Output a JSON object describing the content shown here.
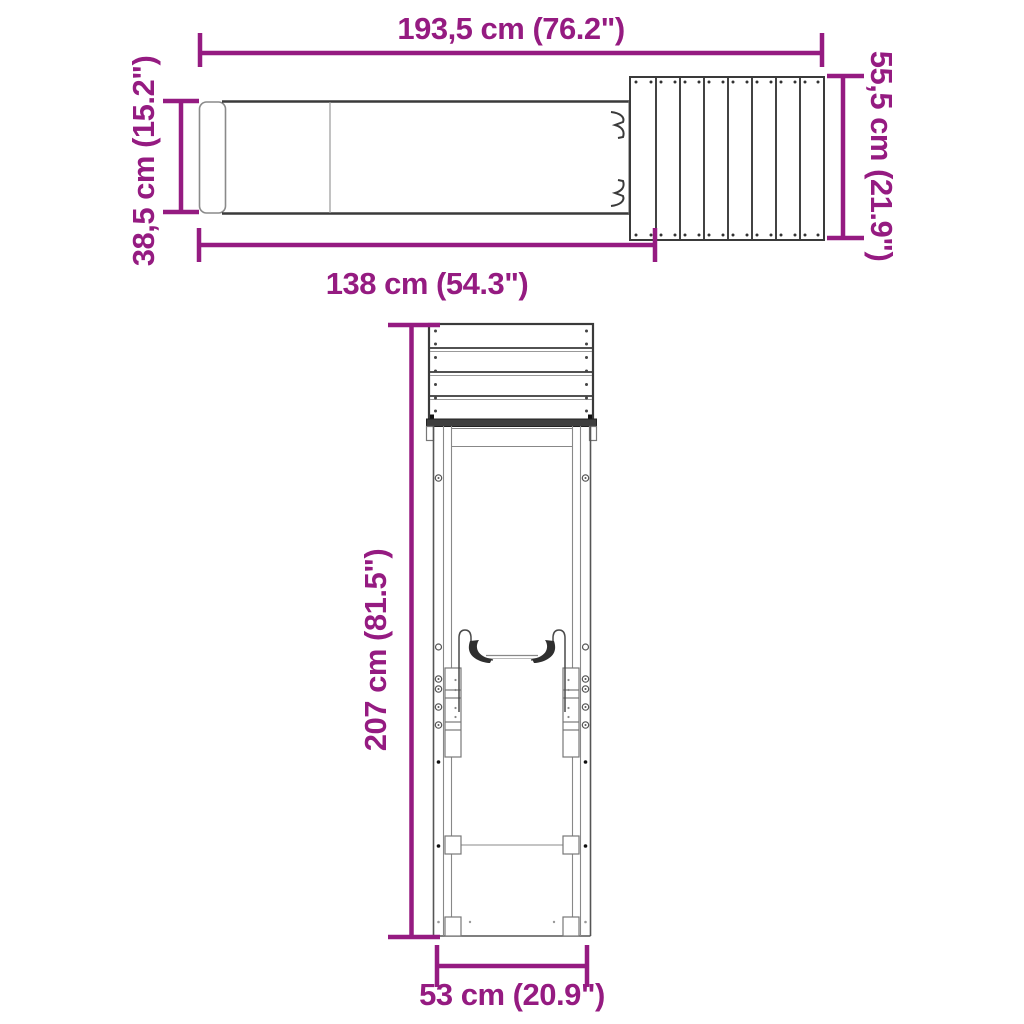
{
  "diagram": {
    "colors": {
      "accent": "#951B81",
      "line": "#3A3A3A",
      "background": "#FFFFFF"
    },
    "views": {
      "top_view": {
        "dimensions": {
          "overall_length": {
            "label": "193,5 cm (76.2\")"
          },
          "platform_depth": {
            "label": "55,5 cm (21.9\")"
          },
          "slide_width": {
            "label": "38,5 cm (15.2\")"
          },
          "slide_length": {
            "label": "138 cm (54.3\")"
          }
        }
      },
      "front_view": {
        "dimensions": {
          "overall_height": {
            "label": "207 cm (81.5\")"
          },
          "base_width": {
            "label": "53 cm (20.9\")"
          }
        }
      }
    }
  }
}
